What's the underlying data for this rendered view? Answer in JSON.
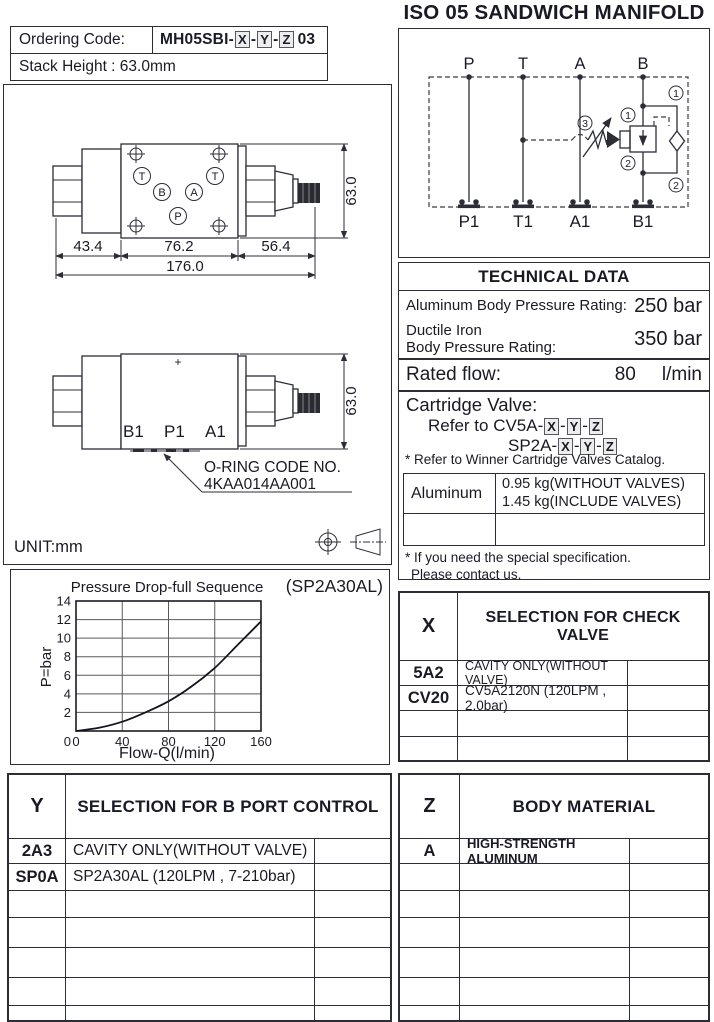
{
  "page_title": "ISO 05 SANDWICH MANIFOLD",
  "ordering": {
    "label": "Ordering Code:",
    "code_prefix": "MH05SBI-",
    "box_x": "X",
    "dash1": "-",
    "box_y": "Y",
    "dash2": "-",
    "box_z": "Z",
    "code_suffix": "03",
    "stack_height": "Stack Height : 63.0mm"
  },
  "schematic": {
    "top_ports": [
      "P",
      "T",
      "A",
      "B"
    ],
    "bottom_ports": [
      "P1",
      "T1",
      "A1",
      "B1"
    ],
    "callout_1": "1",
    "callout_2": "2",
    "callout_3": "3"
  },
  "drawing_top": {
    "port_t_left": "T",
    "port_t_right": "T",
    "port_b": "B",
    "port_a": "A",
    "port_p": "P",
    "dim_left": "43.4",
    "dim_mid": "76.2",
    "dim_right": "56.4",
    "dim_total": "176.0",
    "dim_height": "63.0"
  },
  "drawing_side": {
    "plus_mark": "+",
    "port_b1": "B1",
    "port_p1": "P1",
    "port_a1": "A1",
    "dim_height": "63.0",
    "oring_line1": "O-RING CODE NO.",
    "oring_line2": "4KAA014AA001"
  },
  "unit_label": "UNIT:mm",
  "chart_data": {
    "type": "line",
    "title": "Pressure Drop-full Sequence",
    "annotation": "(SP2A30AL)",
    "xlabel": "Flow-Q(l/min)",
    "ylabel": "P=bar",
    "xlim": [
      0,
      160
    ],
    "ylim": [
      0,
      14
    ],
    "x_ticks": [
      0,
      40,
      80,
      120,
      160
    ],
    "y_ticks": [
      2,
      4,
      6,
      8,
      10,
      12,
      14
    ],
    "grid": true,
    "series": [
      {
        "name": "pressure-drop-full-sequence",
        "x": [
          0,
          20,
          40,
          60,
          80,
          100,
          120,
          140,
          160
        ],
        "y": [
          0,
          0.35,
          1.0,
          2.0,
          3.2,
          4.8,
          6.8,
          9.3,
          11.8
        ]
      }
    ]
  },
  "technical": {
    "header": "TECHNICAL DATA",
    "row1_label": "Aluminum Body Pressure Rating:",
    "row1_value": "250 bar",
    "row2_label_line1": "Ductile Iron",
    "row2_label_line2": "Body Pressure Rating:",
    "row2_value": "350 bar",
    "rated_flow_label": "Rated flow:",
    "rated_flow_value": "80",
    "rated_flow_unit": "l/min",
    "cartridge_title": "Cartridge Valve:",
    "cartridge_ref1_prefix": "Refer to CV5A-",
    "cartridge_ref2_prefix": "SP2A-",
    "box_x": "X",
    "dash1": "-",
    "box_y": "Y",
    "dash2": "-",
    "box_z": "Z",
    "note_catalog": "* Refer to Winner Cartridge Valves Catalog.",
    "weight_material": "Aluminum",
    "weight_line1": "0.95  kg(WITHOUT VALVES)",
    "weight_line2": "1.45  kg(INCLUDE VALVES)",
    "note_special_line1": "* If you need the special specification.",
    "note_special_line2": "Please contact us."
  },
  "x_table": {
    "key": "X",
    "header": "SELECTION FOR CHECK VALVE",
    "rows": [
      {
        "code": "5A2",
        "desc": "CAVITY ONLY(WITHOUT VALVE)"
      },
      {
        "code": "CV20",
        "desc": "CV5A2120N (120LPM , 2.0bar)"
      },
      {
        "code": "",
        "desc": ""
      },
      {
        "code": "",
        "desc": ""
      }
    ]
  },
  "y_table": {
    "key": "Y",
    "header": "SELECTION FOR B PORT  CONTROL",
    "rows": [
      {
        "code": "2A3",
        "desc": "CAVITY ONLY(WITHOUT VALVE)"
      },
      {
        "code": "SP0A",
        "desc": "SP2A30AL (120LPM , 7-210bar)"
      },
      {
        "code": "",
        "desc": ""
      },
      {
        "code": "",
        "desc": ""
      },
      {
        "code": "",
        "desc": ""
      },
      {
        "code": "",
        "desc": ""
      },
      {
        "code": "",
        "desc": ""
      }
    ]
  },
  "z_table": {
    "key": "Z",
    "header": "BODY MATERIAL",
    "rows": [
      {
        "code": "A",
        "desc": "HIGH-STRENGTH ALUMINUM"
      },
      {
        "code": "",
        "desc": ""
      },
      {
        "code": "",
        "desc": ""
      },
      {
        "code": "",
        "desc": ""
      },
      {
        "code": "",
        "desc": ""
      },
      {
        "code": "",
        "desc": ""
      },
      {
        "code": "",
        "desc": ""
      }
    ]
  },
  "colors": {
    "ink": "#1a1a26",
    "line": "#2d2d38"
  }
}
